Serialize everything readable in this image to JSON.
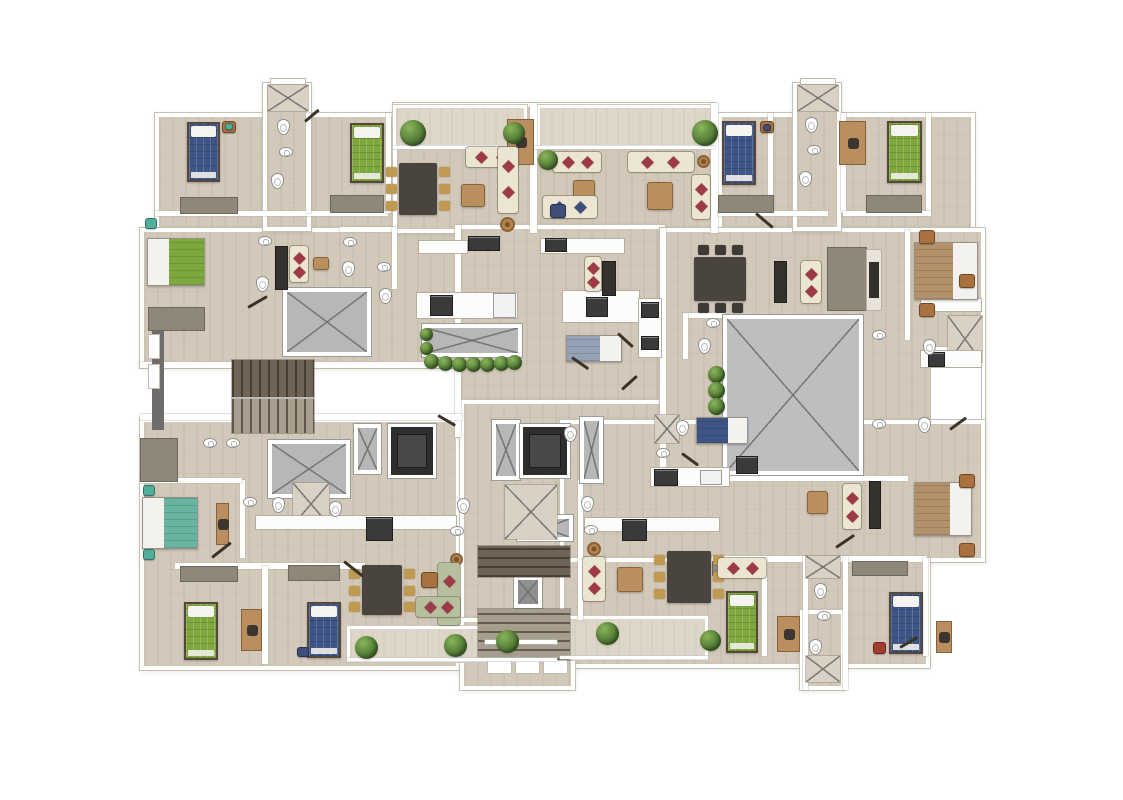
{
  "canvas": {
    "w": 1123,
    "h": 800,
    "bg": "#ffffff"
  },
  "palette": {
    "floor": "#d2c9ba",
    "balcony": "#ded7c9",
    "shaft": "#b7b7b7",
    "shaftB": "#bdbec0",
    "shaftD": "#8f8f8f",
    "stairD": "#6f6356",
    "stairL": "#a89e8e",
    "blue": "#3d5484",
    "green": "#7ea83e",
    "teal": "#68b4a1",
    "tan": "#b3916b",
    "steel": "#93a2b4",
    "cream": "#ece5d2",
    "green2": "#b6bf9e",
    "navy": "#3e4e78",
    "red": "#9e3a48",
    "wood": "#b98f60",
    "gold": "#c19a52",
    "dwood": "#4a443e",
    "chairDark": "#3e3a35",
    "potW": "#a9713d",
    "potT": "#4fae9c",
    "potR": "#a33c30"
  },
  "element_names": {
    "floor": "floor-area",
    "balcony": "balcony",
    "wall": "wall",
    "wallD": "dark-wall",
    "sill": "window-sill",
    "rail": "railing",
    "shaft": "shaft-x",
    "shaftL": "closet-x",
    "elev": "elevator",
    "stV": "staircase",
    "stH": "staircase",
    "counter": "kitchen-counter",
    "appl": "appliance",
    "fridge": "refrigerator",
    "ward": "wardrobe",
    "desk": "desk",
    "tv": "tv-unit",
    "tvst": "tv-stand",
    "dining": "dining-table",
    "table": "coffee-table",
    "tableR": "side-table",
    "sofa": "sofa",
    "bedS": "single-bed",
    "bedD": "double-bed",
    "toilet": "toilet-fixture",
    "sink": "sink-fixture",
    "plant": "plant",
    "pot": "plant-pot",
    "door": "door-leaf"
  },
  "elements": [
    [
      "floor",
      155,
      113,
      375,
      145
    ],
    [
      "floor",
      140,
      228,
      320,
      140
    ],
    [
      "floor",
      140,
      418,
      320,
      252
    ],
    [
      "floor",
      393,
      103,
      322,
      130
    ],
    [
      "floor",
      457,
      225,
      208,
      212
    ],
    [
      "floor",
      460,
      400,
      208,
      262
    ],
    [
      "floor",
      718,
      113,
      257,
      147
    ],
    [
      "floor",
      660,
      228,
      325,
      250
    ],
    [
      "floor",
      560,
      420,
      425,
      142
    ],
    [
      "floor",
      560,
      558,
      370,
      110
    ],
    [
      "floor",
      263,
      83,
      48,
      148
    ],
    [
      "floor",
      793,
      83,
      48,
      148
    ],
    [
      "floor",
      460,
      618,
      115,
      72
    ],
    [
      "floor",
      800,
      610,
      45,
      80
    ],
    [
      "balcony",
      393,
      105,
      134,
      43
    ],
    [
      "balcony",
      537,
      105,
      178,
      43
    ],
    [
      "balcony",
      347,
      626,
      210,
      36
    ],
    [
      "balcony",
      560,
      616,
      148,
      44
    ],
    [
      "wall",
      530,
      103,
      7,
      130
    ],
    [
      "wall",
      711,
      103,
      7,
      130
    ],
    [
      "wall",
      155,
      211,
      233,
      5
    ],
    [
      "wall",
      306,
      113,
      5,
      100
    ],
    [
      "wall",
      386,
      113,
      5,
      100
    ],
    [
      "wall",
      768,
      113,
      5,
      100
    ],
    [
      "wall",
      841,
      113,
      5,
      100
    ],
    [
      "wall",
      926,
      113,
      5,
      100
    ],
    [
      "wall",
      718,
      211,
      110,
      5
    ],
    [
      "wall",
      843,
      211,
      88,
      5
    ],
    [
      "wall",
      455,
      225,
      6,
      212
    ],
    [
      "wall",
      660,
      228,
      6,
      250
    ],
    [
      "wall",
      140,
      362,
      92,
      6
    ],
    [
      "wall",
      314,
      362,
      148,
      6
    ],
    [
      "wall",
      140,
      414,
      92,
      6
    ],
    [
      "wall",
      314,
      414,
      148,
      6
    ],
    [
      "wall",
      240,
      480,
      5,
      78
    ],
    [
      "wall",
      140,
      478,
      102,
      5
    ],
    [
      "wall",
      175,
      563,
      190,
      6
    ],
    [
      "wall",
      262,
      566,
      6,
      98
    ],
    [
      "wall",
      712,
      556,
      215,
      6
    ],
    [
      "wall",
      762,
      558,
      5,
      98
    ],
    [
      "wall",
      803,
      556,
      5,
      134
    ],
    [
      "wall",
      843,
      556,
      5,
      134
    ],
    [
      "wall",
      923,
      558,
      5,
      98
    ],
    [
      "wall",
      905,
      230,
      5,
      110
    ],
    [
      "wall",
      665,
      476,
      243,
      5
    ],
    [
      "wall",
      578,
      480,
      5,
      140
    ],
    [
      "wall",
      340,
      227,
      56,
      5
    ],
    [
      "wall",
      392,
      227,
      5,
      62
    ],
    [
      "wall",
      683,
      313,
      42,
      5
    ],
    [
      "wall",
      683,
      313,
      5,
      46
    ],
    [
      "wallD",
      152,
      322,
      12,
      108
    ],
    [
      "sill",
      270,
      78,
      36,
      7
    ],
    [
      "sill",
      800,
      78,
      36,
      7
    ],
    [
      "sill",
      148,
      334,
      12,
      25
    ],
    [
      "sill",
      148,
      364,
      12,
      25
    ],
    [
      "sill",
      487,
      655,
      25,
      19
    ],
    [
      "sill",
      515,
      655,
      25,
      19
    ],
    [
      "sill",
      543,
      655,
      25,
      19
    ],
    [
      "sill",
      930,
      346,
      52,
      74
    ],
    [
      "shaft",
      283,
      288,
      88,
      68
    ],
    [
      "shaft",
      422,
      324,
      100,
      33
    ],
    [
      "shaft",
      723,
      315,
      140,
      160,
      "b"
    ],
    [
      "shaft",
      268,
      440,
      82,
      58
    ],
    [
      "shaft",
      354,
      424,
      27,
      50
    ],
    [
      "shaft",
      580,
      417,
      23,
      66
    ],
    [
      "shaft",
      492,
      420,
      28,
      60
    ],
    [
      "shaft",
      517,
      515,
      56,
      26
    ],
    [
      "shaft",
      514,
      576,
      28,
      32,
      "d"
    ],
    [
      "shaftL",
      948,
      316,
      34,
      46
    ],
    [
      "shaftL",
      806,
      556,
      34,
      22
    ],
    [
      "shaftL",
      806,
      656,
      34,
      26
    ],
    [
      "shaftL",
      268,
      85,
      40,
      26
    ],
    [
      "shaftL",
      798,
      85,
      40,
      26
    ],
    [
      "shaftL",
      293,
      483,
      36,
      42
    ],
    [
      "shaftL",
      505,
      485,
      52,
      54
    ],
    [
      "shaftL",
      655,
      415,
      24,
      28
    ],
    [
      "elev",
      388,
      424,
      48,
      54
    ],
    [
      "elev",
      520,
      424,
      50,
      54
    ],
    [
      "stV",
      232,
      360,
      82,
      37,
      "d"
    ],
    [
      "stV",
      232,
      399,
      82,
      34,
      "l"
    ],
    [
      "stH",
      478,
      546,
      92,
      31,
      "d"
    ],
    [
      "stH",
      478,
      609,
      92,
      51,
      "l"
    ],
    [
      "rail",
      485,
      640,
      72,
      4
    ],
    [
      "rail",
      393,
      146,
      322,
      3
    ],
    [
      "rail",
      347,
      658,
      210,
      3
    ],
    [
      "rail",
      560,
      656,
      148,
      3
    ],
    [
      "counter",
      418,
      240,
      50,
      14
    ],
    [
      "appl",
      468,
      236,
      32,
      15
    ],
    [
      "counter",
      540,
      238,
      85,
      16
    ],
    [
      "appl",
      545,
      238,
      22,
      14
    ],
    [
      "counter",
      416,
      292,
      102,
      27
    ],
    [
      "appl",
      430,
      295,
      23,
      21
    ],
    [
      "fridge",
      493,
      293,
      23,
      25
    ],
    [
      "counter",
      562,
      290,
      78,
      33
    ],
    [
      "appl",
      586,
      297,
      22,
      20
    ],
    [
      "counter",
      638,
      298,
      24,
      60
    ],
    [
      "appl",
      641,
      302,
      18,
      16
    ],
    [
      "appl",
      641,
      336,
      18,
      14
    ],
    [
      "counter",
      255,
      515,
      202,
      15
    ],
    [
      "appl",
      366,
      517,
      27,
      24
    ],
    [
      "counter",
      584,
      517,
      136,
      15
    ],
    [
      "appl",
      622,
      519,
      25,
      22
    ],
    [
      "counter",
      650,
      467,
      80,
      20
    ],
    [
      "appl",
      654,
      469,
      24,
      17
    ],
    [
      "fridge",
      700,
      470,
      22,
      15
    ],
    [
      "appl",
      736,
      456,
      22,
      18
    ],
    [
      "counter",
      920,
      350,
      62,
      18
    ],
    [
      "appl",
      928,
      352,
      17,
      15
    ],
    [
      "counter",
      920,
      298,
      62,
      14
    ],
    [
      "ward",
      180,
      197,
      58,
      17
    ],
    [
      "ward",
      330,
      195,
      54,
      18
    ],
    [
      "ward",
      718,
      195,
      56,
      18
    ],
    [
      "ward",
      866,
      195,
      56,
      18
    ],
    [
      "ward",
      148,
      307,
      57,
      24
    ],
    [
      "ward",
      140,
      438,
      38,
      44
    ],
    [
      "ward",
      180,
      566,
      58,
      16
    ],
    [
      "ward",
      288,
      565,
      52,
      16
    ],
    [
      "ward",
      712,
      561,
      28,
      15
    ],
    [
      "ward",
      852,
      561,
      56,
      15
    ],
    [
      "ward",
      827,
      247,
      40,
      64
    ],
    [
      "tv",
      275,
      246,
      13,
      44
    ],
    [
      "tv",
      602,
      261,
      14,
      35
    ],
    [
      "tv",
      774,
      261,
      13,
      42
    ],
    [
      "tv",
      869,
      481,
      12,
      48
    ],
    [
      "tvst",
      866,
      249,
      16,
      62
    ],
    [
      "desk",
      507,
      119,
      27,
      46
    ],
    [
      "desk",
      839,
      121,
      27,
      44
    ],
    [
      "desk",
      241,
      609,
      21,
      42
    ],
    [
      "desk",
      777,
      616,
      23,
      36
    ],
    [
      "desk",
      936,
      621,
      16,
      32
    ],
    [
      "desk",
      216,
      503,
      13,
      42
    ],
    [
      "dining",
      399,
      163,
      38,
      52,
      "g"
    ],
    [
      "dining",
      694,
      257,
      52,
      44,
      "d"
    ],
    [
      "dining",
      362,
      565,
      40,
      50,
      "g"
    ],
    [
      "dining",
      667,
      551,
      44,
      52,
      "g"
    ],
    [
      "table",
      461,
      184,
      24,
      23
    ],
    [
      "table",
      573,
      180,
      22,
      26
    ],
    [
      "table",
      647,
      182,
      26,
      28
    ],
    [
      "table",
      617,
      567,
      26,
      25
    ],
    [
      "table",
      807,
      491,
      21,
      23
    ],
    [
      "table",
      313,
      257,
      16,
      13
    ],
    [
      "tableR",
      500,
      217,
      15,
      15
    ],
    [
      "tableR",
      697,
      155,
      13,
      13
    ],
    [
      "tableR",
      450,
      553,
      13,
      13
    ],
    [
      "tableR",
      587,
      542,
      14,
      14
    ],
    [
      "sofa",
      466,
      147,
      52,
      20,
      "cream"
    ],
    [
      "sofa",
      498,
      147,
      20,
      66,
      "cream"
    ],
    [
      "sofa",
      553,
      152,
      48,
      20,
      "cream"
    ],
    [
      "sofa",
      543,
      196,
      54,
      22,
      "cream",
      "n"
    ],
    [
      "sofa",
      628,
      152,
      66,
      20,
      "cream"
    ],
    [
      "sofa",
      692,
      175,
      18,
      44,
      "cream"
    ],
    [
      "sofa",
      290,
      246,
      18,
      36,
      "cream"
    ],
    [
      "sofa",
      585,
      257,
      16,
      34,
      "cream"
    ],
    [
      "sofa",
      801,
      261,
      20,
      42,
      "cream"
    ],
    [
      "sofa",
      843,
      484,
      18,
      45,
      "cream"
    ],
    [
      "sofa",
      583,
      557,
      22,
      44,
      "cream"
    ],
    [
      "sofa",
      718,
      558,
      48,
      20,
      "cream"
    ],
    [
      "sofa",
      438,
      563,
      22,
      62,
      "green2"
    ],
    [
      "sofa",
      416,
      597,
      44,
      20,
      "green2"
    ],
    [
      "bedS",
      187,
      122,
      33,
      60,
      "blue"
    ],
    [
      "bedS",
      350,
      123,
      34,
      60,
      "green"
    ],
    [
      "bedS",
      722,
      121,
      34,
      64,
      "blue"
    ],
    [
      "bedS",
      887,
      121,
      35,
      62,
      "green"
    ],
    [
      "bedS",
      184,
      602,
      34,
      58,
      "green"
    ],
    [
      "bedS",
      307,
      602,
      34,
      56,
      "blue"
    ],
    [
      "bedS",
      726,
      591,
      32,
      62,
      "green"
    ],
    [
      "bedS",
      889,
      592,
      34,
      62,
      "blue"
    ],
    [
      "bedD",
      147,
      238,
      58,
      48,
      "green",
      "l"
    ],
    [
      "bedD",
      142,
      497,
      56,
      52,
      "teal",
      "l"
    ],
    [
      "bedD",
      914,
      242,
      64,
      58,
      "tan",
      "r"
    ],
    [
      "bedD",
      914,
      482,
      58,
      54,
      "tan",
      "r"
    ],
    [
      "bedD",
      566,
      335,
      56,
      27,
      "steel",
      "r"
    ],
    [
      "bedD",
      696,
      417,
      52,
      27,
      "blue",
      "r"
    ],
    [
      "toilet",
      277,
      119,
      13,
      16
    ],
    [
      "sink",
      279,
      147,
      14,
      10
    ],
    [
      "toilet",
      271,
      173,
      13,
      16
    ],
    [
      "sink",
      343,
      237,
      14,
      10
    ],
    [
      "toilet",
      342,
      261,
      13,
      16
    ],
    [
      "sink",
      258,
      236,
      14,
      10
    ],
    [
      "toilet",
      256,
      276,
      13,
      16
    ],
    [
      "sink",
      377,
      262,
      14,
      10
    ],
    [
      "toilet",
      379,
      288,
      13,
      16
    ],
    [
      "toilet",
      805,
      117,
      13,
      16
    ],
    [
      "sink",
      807,
      145,
      14,
      10
    ],
    [
      "toilet",
      799,
      171,
      13,
      16
    ],
    [
      "sink",
      872,
      330,
      14,
      10
    ],
    [
      "toilet",
      923,
      339,
      13,
      16
    ],
    [
      "sink",
      872,
      419,
      14,
      10
    ],
    [
      "toilet",
      918,
      417,
      13,
      16
    ],
    [
      "toilet",
      814,
      583,
      13,
      16
    ],
    [
      "sink",
      817,
      611,
      14,
      10
    ],
    [
      "toilet",
      809,
      639,
      13,
      16
    ],
    [
      "toilet",
      581,
      496,
      13,
      16
    ],
    [
      "sink",
      584,
      525,
      14,
      10
    ],
    [
      "toilet",
      272,
      497,
      13,
      16
    ],
    [
      "sink",
      243,
      497,
      14,
      10
    ],
    [
      "sink",
      203,
      438,
      14,
      10
    ],
    [
      "sink",
      226,
      438,
      14,
      10
    ],
    [
      "toilet",
      329,
      501,
      13,
      16
    ],
    [
      "toilet",
      457,
      498,
      13,
      16
    ],
    [
      "sink",
      450,
      526,
      14,
      10
    ],
    [
      "toilet",
      676,
      420,
      13,
      16
    ],
    [
      "sink",
      656,
      448,
      14,
      10
    ],
    [
      "sink",
      706,
      318,
      14,
      10
    ],
    [
      "toilet",
      698,
      338,
      13,
      16
    ],
    [
      "toilet",
      564,
      426,
      13,
      16
    ],
    [
      "plant",
      400,
      120,
      26,
      26
    ],
    [
      "plant",
      503,
      122,
      22,
      22
    ],
    [
      "plant",
      538,
      150,
      20,
      20
    ],
    [
      "plant",
      692,
      120,
      26,
      26
    ],
    [
      "plant",
      420,
      328,
      13,
      13
    ],
    [
      "plant",
      420,
      342,
      13,
      13
    ],
    [
      "plant",
      424,
      354,
      15,
      15
    ],
    [
      "plant",
      438,
      356,
      15,
      15
    ],
    [
      "plant",
      452,
      357,
      15,
      15
    ],
    [
      "plant",
      466,
      357,
      15,
      15
    ],
    [
      "plant",
      480,
      357,
      15,
      15
    ],
    [
      "plant",
      494,
      356,
      15,
      15
    ],
    [
      "plant",
      507,
      355,
      15,
      15
    ],
    [
      "plant",
      708,
      366,
      17,
      17
    ],
    [
      "plant",
      708,
      382,
      17,
      17
    ],
    [
      "plant",
      708,
      398,
      17,
      17
    ],
    [
      "plant",
      355,
      636,
      23,
      23
    ],
    [
      "plant",
      444,
      634,
      23,
      23
    ],
    [
      "plant",
      496,
      630,
      23,
      23
    ],
    [
      "plant",
      596,
      622,
      23,
      23
    ],
    [
      "plant",
      700,
      630,
      21,
      21
    ],
    [
      "pot",
      222,
      121,
      14,
      12,
      "wd"
    ],
    [
      "pot",
      225,
      123,
      8,
      7,
      "tealp"
    ],
    [
      "pot",
      760,
      121,
      14,
      12,
      "wd"
    ],
    [
      "pot",
      763,
      124,
      8,
      7,
      "navyp"
    ],
    [
      "pot",
      919,
      230,
      16,
      14,
      "wd"
    ],
    [
      "pot",
      919,
      303,
      16,
      14,
      "wd"
    ],
    [
      "pot",
      959,
      274,
      16,
      14,
      "wd"
    ],
    [
      "pot",
      959,
      474,
      16,
      14,
      "wd"
    ],
    [
      "pot",
      959,
      543,
      16,
      14,
      "wd"
    ],
    [
      "pot",
      873,
      642,
      13,
      12,
      "redp"
    ],
    [
      "pot",
      143,
      485,
      12,
      11,
      "tealp"
    ],
    [
      "pot",
      143,
      549,
      12,
      11,
      "tealp"
    ],
    [
      "pot",
      145,
      218,
      12,
      11,
      "tealp"
    ],
    [
      "pot",
      297,
      647,
      12,
      10,
      "navyp"
    ],
    [
      "pot",
      550,
      204,
      16,
      14,
      "navyp"
    ],
    [
      "pot",
      421,
      572,
      17,
      16,
      "wd"
    ],
    [
      "door",
      212,
      556,
      24,
      3,
      -38
    ],
    [
      "door",
      344,
      560,
      24,
      3,
      38
    ],
    [
      "door",
      248,
      306,
      22,
      3,
      -30
    ],
    [
      "door",
      618,
      332,
      20,
      3,
      42
    ],
    [
      "door",
      622,
      388,
      20,
      3,
      -42
    ],
    [
      "door",
      682,
      452,
      20,
      3,
      36
    ],
    [
      "door",
      950,
      428,
      20,
      3,
      -36
    ],
    [
      "door",
      756,
      212,
      22,
      3,
      40
    ],
    [
      "door",
      836,
      546,
      22,
      3,
      -34
    ],
    [
      "door",
      438,
      414,
      20,
      3,
      30
    ],
    [
      "door",
      900,
      646,
      20,
      3,
      -30
    ],
    [
      "door",
      572,
      356,
      20,
      3,
      35
    ],
    [
      "door",
      305,
      120,
      18,
      3,
      -40
    ]
  ]
}
